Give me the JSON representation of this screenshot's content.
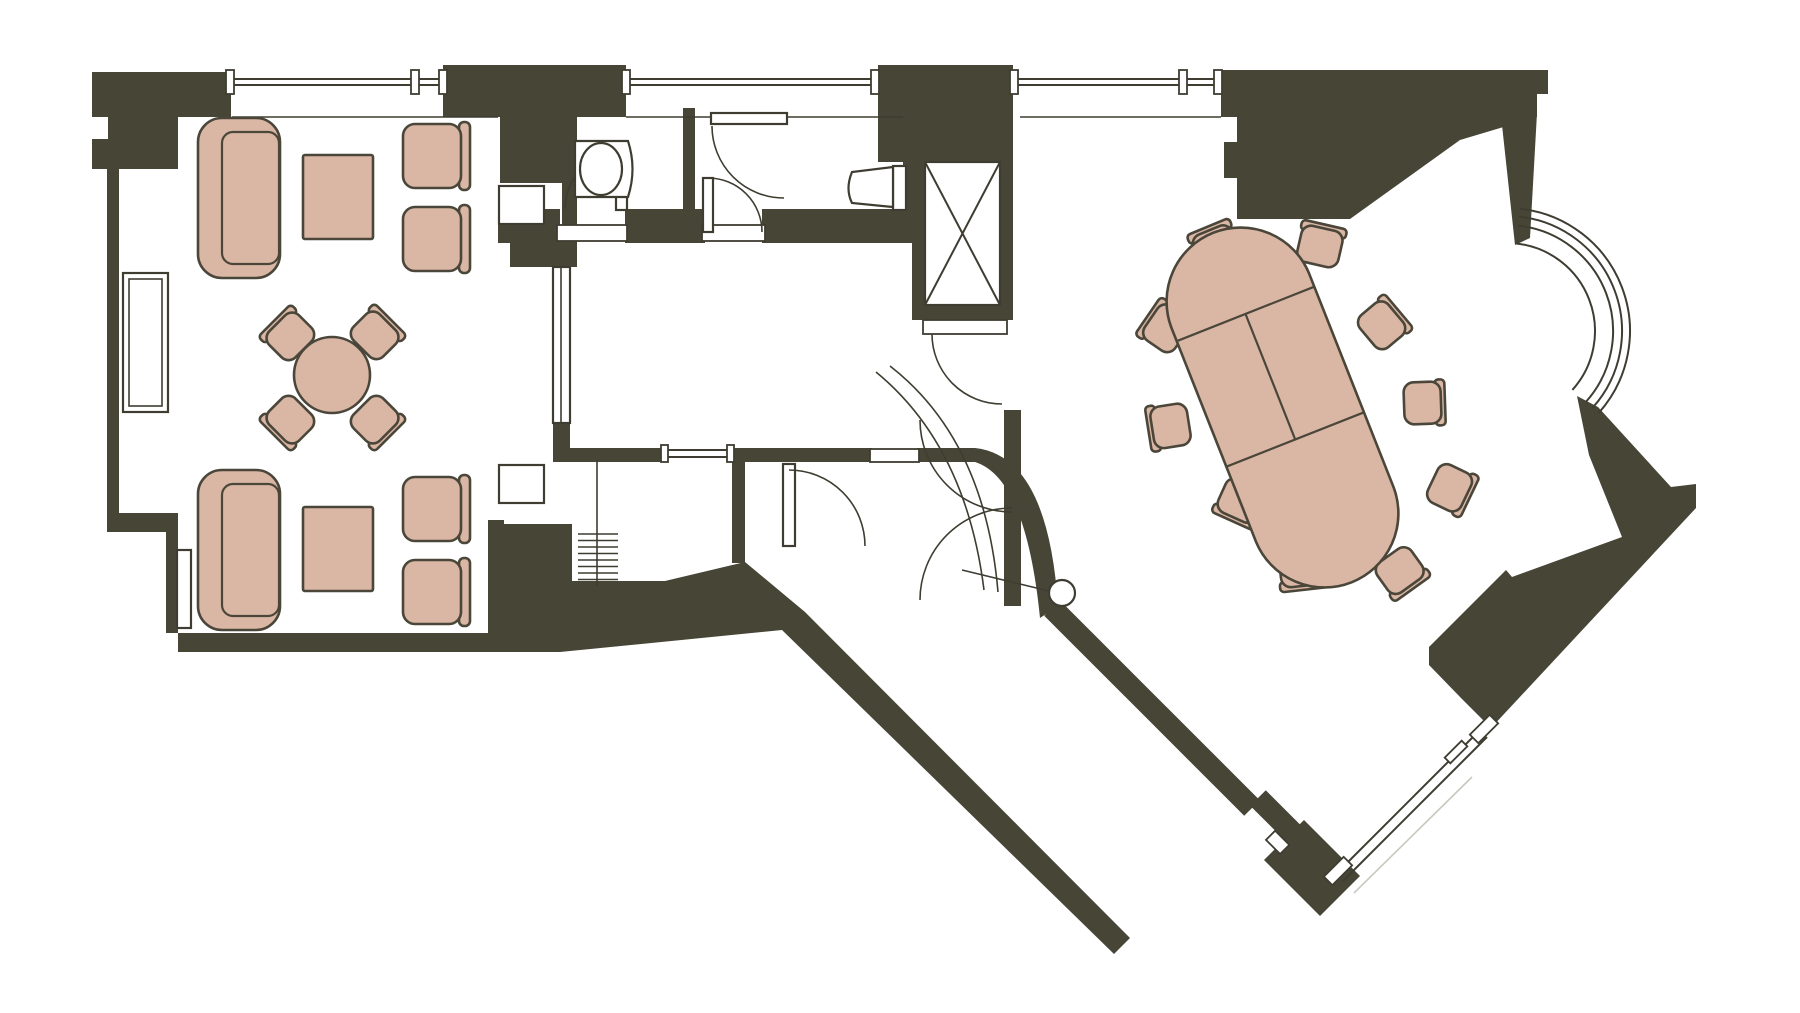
{
  "document": {
    "type": "architectural-floor-plan",
    "description": "Top-view floor plan of a suite: lounge with two sofa groups and round table, bathroom, WC, elevator shaft, corridor, staircase, entry vestibule with curved wall, and an angled meeting room with oval conference table, bay window and diagonal glazed walls."
  },
  "colors": {
    "background": "#ffffff",
    "wall": "#474536",
    "line": "#3f3d31",
    "furniture_fill": "#dab6a5",
    "furniture_stroke": "#4a4639",
    "faint": "#c9c7bf"
  },
  "rooms": [
    {
      "name": "lounge"
    },
    {
      "name": "bathroom"
    },
    {
      "name": "wc"
    },
    {
      "name": "elevator-shaft"
    },
    {
      "name": "corridor"
    },
    {
      "name": "staircase-room"
    },
    {
      "name": "entry-vestibule"
    },
    {
      "name": "meeting-room"
    }
  ],
  "furniture_inventory": {
    "sofas": 2,
    "coffee_tables": 2,
    "armchairs": 4,
    "round_table": 1,
    "dining_chairs": 4,
    "side_tables": 2,
    "conference_table": 1,
    "conference_chairs": 10,
    "washbasin": 1,
    "toilet": 1,
    "staircase": 1,
    "elevator": 1,
    "windows": 8,
    "doors": 8
  }
}
